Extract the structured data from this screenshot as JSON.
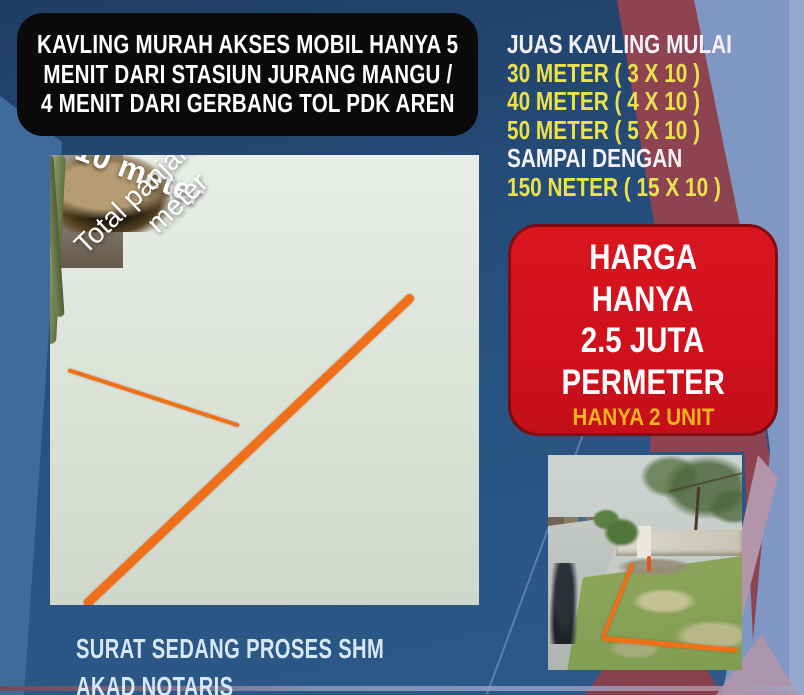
{
  "poster": {
    "headline_lines": [
      "KAVLING MURAH AKSES MOBIL HANYA 5",
      "MENIT DARI STASIUN JURANG MANGU /",
      "4 MENIT DARI GERBANG TOL PDK AREN"
    ],
    "size_lines": [
      "JUAS KAVLING MULAI",
      "30 METER ( 3 X 10 )",
      "40 METER ( 4 X 10 )",
      "50 METER ( 5 X 10 )",
      "SAMPAI DENGAN",
      "150 NETER ( 15 X 10 )"
    ],
    "price_lines": [
      "HARGA",
      "HANYA",
      "2.5 JUTA",
      "PERMETER"
    ],
    "price_note": "HANYA 2 UNIT",
    "photo_labels": {
      "width": "10 meter",
      "length_line1": "Total panjang 50",
      "length_line2": "meter"
    },
    "footer_lines": [
      "SURAT SEDANG PROSES SHM",
      "AKAD NOTARIS"
    ],
    "colors": {
      "background_navy": "#2a5080",
      "left_band_blue": "#3e6a9c",
      "right_light_blue": "#8096c3",
      "maroon_stripe": "#8d4350",
      "headline_panel_black": "#0a0a0a",
      "price_box_red": "#d6121b",
      "accent_yellow": "#e9e24c",
      "note_yellow": "#f2b41c",
      "annotation_orange": "#f0701a",
      "footer_text_blue": "#d6e8f5"
    }
  }
}
